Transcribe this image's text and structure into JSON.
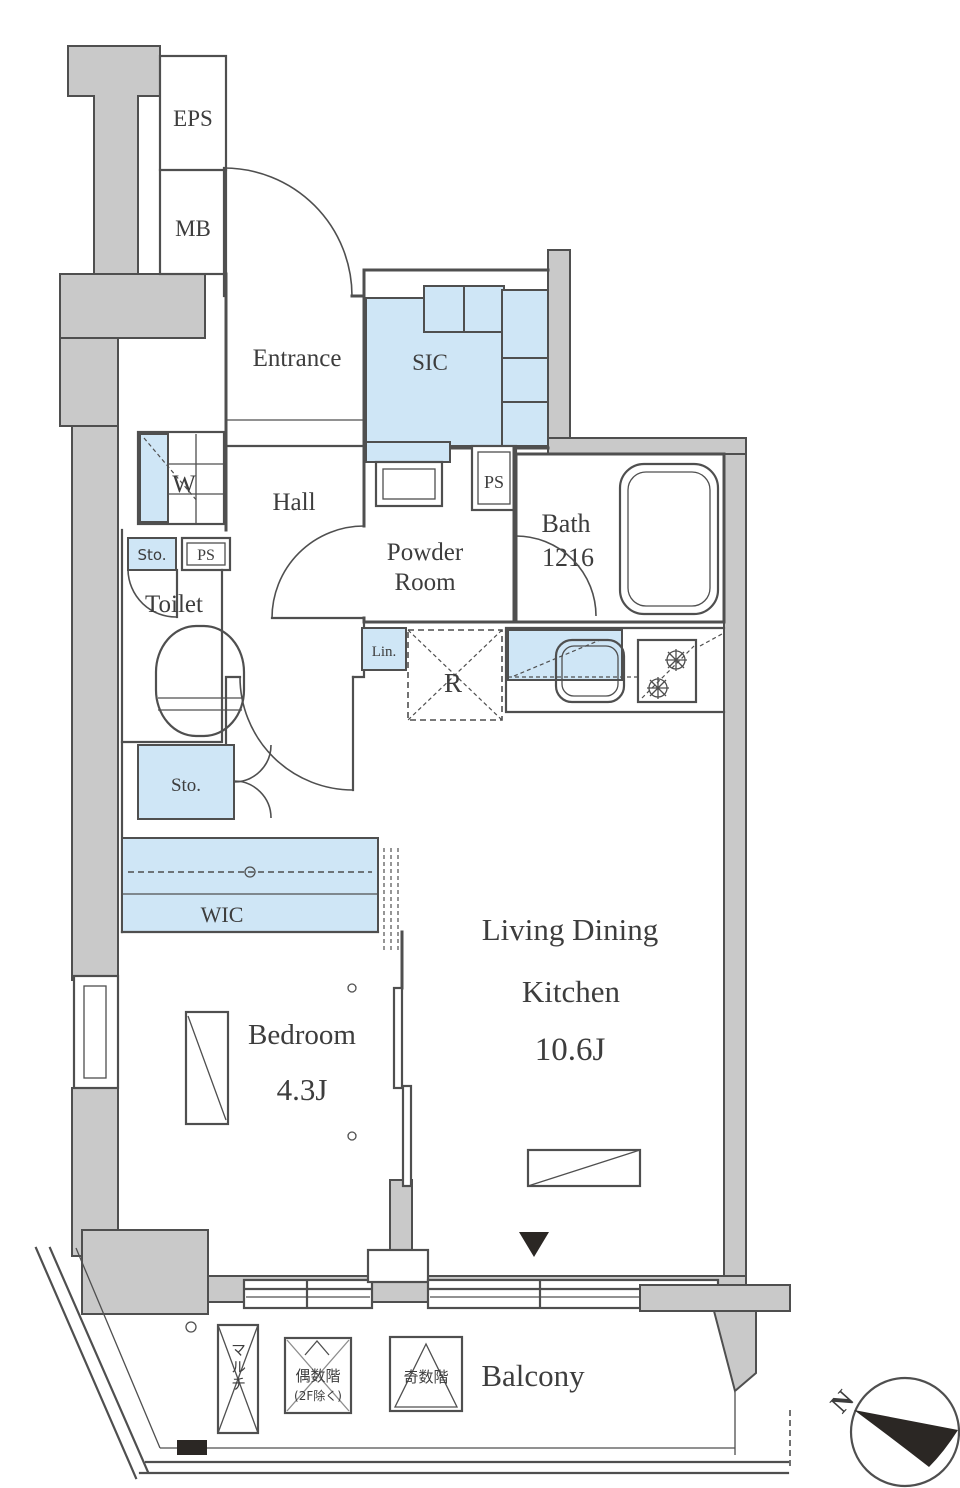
{
  "title": "apartment-floor-plan",
  "labels": {
    "eps": "EPS",
    "mb": "MB",
    "entrance": "Entrance",
    "sic": "SIC",
    "ps_top": "PS",
    "washer": "W",
    "hall": "Hall",
    "sto_top": "Sto.",
    "ps_mid": "PS",
    "toilet": "Toilet",
    "powder_line1": "Powder",
    "powder_line2": "Room",
    "bath": "Bath",
    "bath_size": "1216",
    "linen": "Lin.",
    "fridge": "R",
    "sto_mid": "Sto.",
    "wic": "WIC",
    "bedroom": "Bedroom",
    "bedroom_size": "4.3J",
    "ldk_line1": "Living Dining",
    "ldk_line2": "Kitchen",
    "ldk_size": "10.6J",
    "balcony": "Balcony",
    "multi_rack": "マルチ",
    "even_floors_line1": "偶数階",
    "even_floors_line2": "(2F除く)",
    "odd_floors": "奇数階",
    "north": "N"
  },
  "colors": {
    "fixture": "#cfe6f6",
    "wall": "#c9c9c9",
    "line": "#4f4f4f",
    "text": "#3d3d3d",
    "dark": "#2b2724"
  }
}
